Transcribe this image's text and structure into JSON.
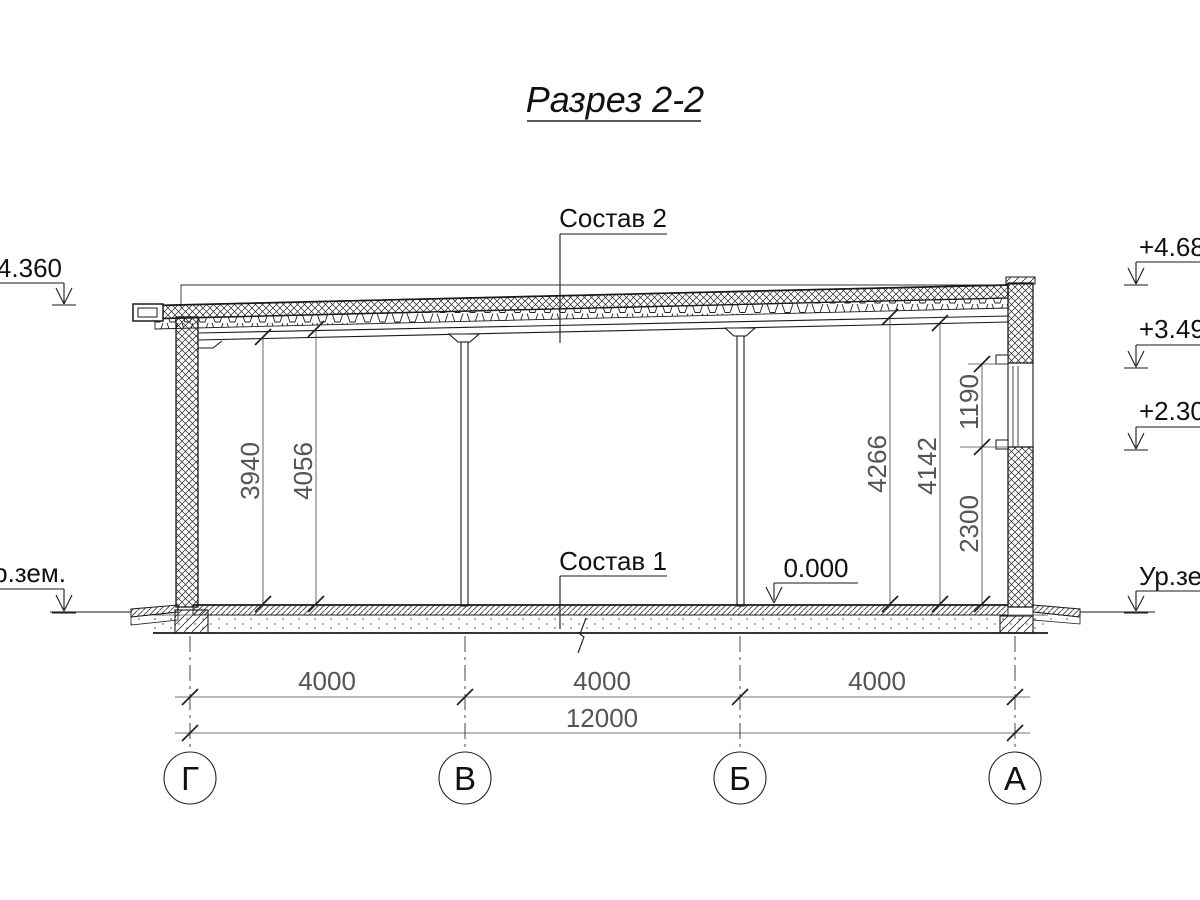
{
  "page": {
    "title": "Разрез 2-2"
  },
  "callouts": {
    "roof_composition": "Состав 2",
    "floor_composition": "Состав 1"
  },
  "elevations": {
    "left_roof": "+4.360",
    "right_parapet": "+4.68",
    "window_head": "+3.49",
    "window_sill": "+2.30",
    "floor_level": "0.000",
    "ground_left": "Ур.зем.",
    "ground_right": "Ур.зем."
  },
  "dimensions": {
    "vertical": [
      "3940",
      "4056",
      "4266",
      "4142",
      "1190",
      "2300"
    ],
    "bottom_spans": [
      "4000",
      "4000",
      "4000"
    ],
    "bottom_total": "12000"
  },
  "axes": [
    "Г",
    "В",
    "Б",
    "А"
  ],
  "colors": {
    "line": "#1a1a1a",
    "dim_text": "#555555",
    "background": "#ffffff"
  }
}
